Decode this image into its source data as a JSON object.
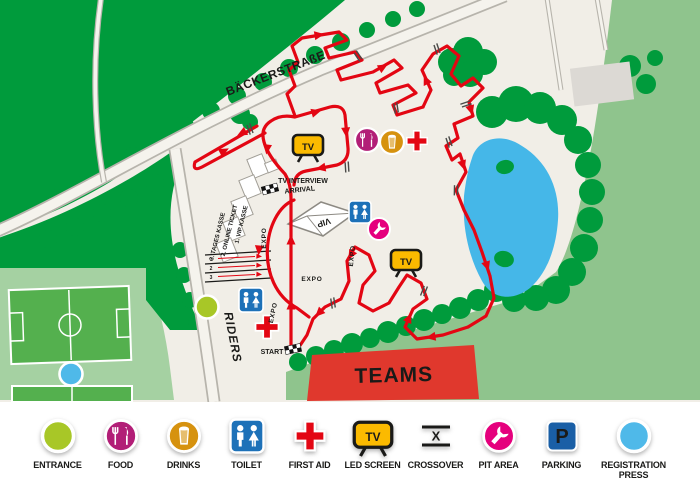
{
  "map": {
    "street_label": "BÄCKERSTRAßE",
    "tv_label": "TV",
    "labels": {
      "tv_interview": "TV INTERVIEW",
      "arrival": "ARRIVAL",
      "vip": "VIP",
      "expo": "EXPO",
      "riders": "RIDERS",
      "start": "START",
      "teams": "TEAMS"
    },
    "ticket_queue": {
      "lines": [
        "1. VIP KASSE",
        "2. ONLINE TICKET",
        "3. TAGES KASSE"
      ],
      "lane_numbers": [
        "1",
        "2",
        "3"
      ]
    }
  },
  "legend": {
    "crossover_x": "X",
    "parking_p": "P",
    "items": [
      {
        "id": "entrance",
        "label": "ENTRANCE",
        "color": "#A8C727"
      },
      {
        "id": "food",
        "label": "FOOD",
        "color": "#B21E77"
      },
      {
        "id": "drinks",
        "label": "DRINKS",
        "color": "#D6920F"
      },
      {
        "id": "toilet",
        "label": "TOILET",
        "color": "#1D71B8"
      },
      {
        "id": "first-aid",
        "label": "FIRST AID",
        "color": "#E30613"
      },
      {
        "id": "led-screen",
        "label": "LED SCREEN",
        "color": "#FBBA00"
      },
      {
        "id": "crossover",
        "label": "CROSSOVER",
        "color": "#1A1A18"
      },
      {
        "id": "pit-area",
        "label": "PIT AREA",
        "color": "#E5007D"
      },
      {
        "id": "parking",
        "label": "PARKING",
        "color": "#1A5FA6"
      },
      {
        "id": "registration-press",
        "label": "REGISTRATION PRESS",
        "color": "#4FB9E9"
      }
    ]
  },
  "colors": {
    "course": "#E30613",
    "forest": "#009B3C",
    "field": "#8FC48D",
    "lake": "#45B7E8",
    "background": "#F1EEE7",
    "teams_banner": "#E0382D"
  }
}
